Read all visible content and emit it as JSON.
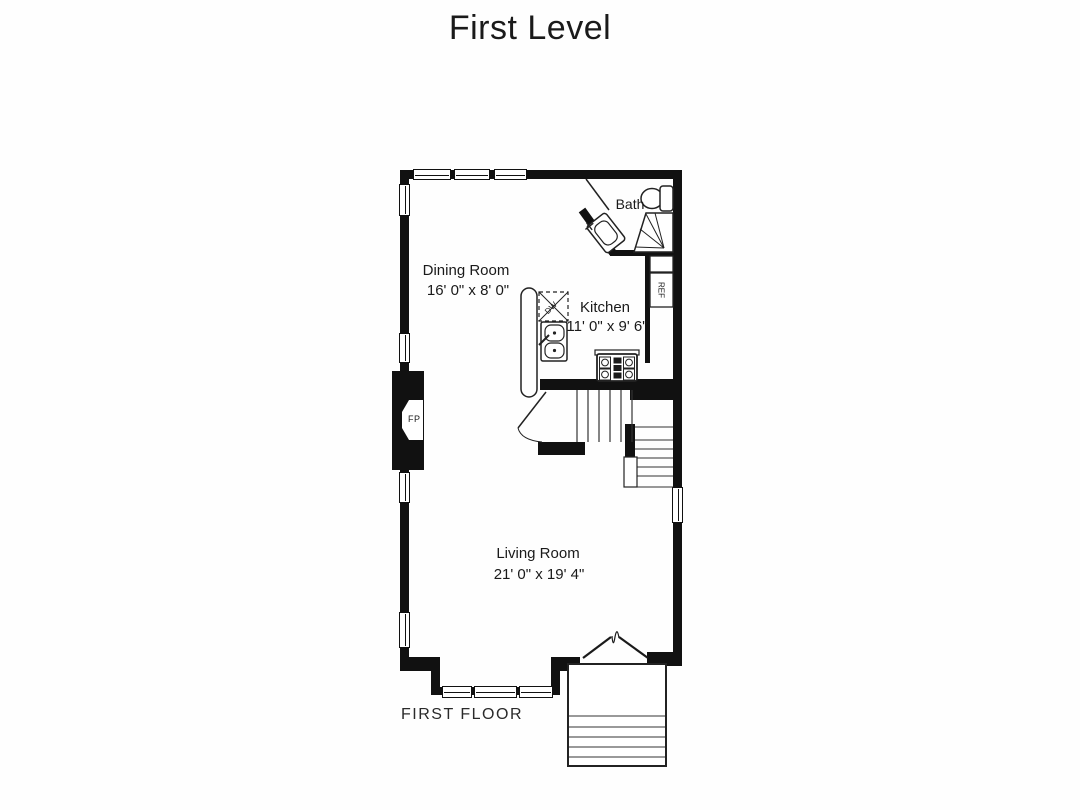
{
  "title": "First Level",
  "footer": {
    "label": "FIRST FLOOR"
  },
  "rooms": {
    "dining": {
      "name": "Dining Room",
      "dims": "16' 0\" x 8' 0\""
    },
    "kitchen": {
      "name": "Kitchen",
      "dims": "11' 0\" x 9' 6\""
    },
    "living": {
      "name": "Living Room",
      "dims": "21' 0\" x 19' 4\""
    },
    "bath": {
      "name": "Bath"
    }
  },
  "fixtures": {
    "fireplace": "FP",
    "refrigerator": "REF",
    "dishwasher": "DW"
  },
  "colors": {
    "wall": "#111111",
    "line": "#222222",
    "background": "#ffffff"
  }
}
